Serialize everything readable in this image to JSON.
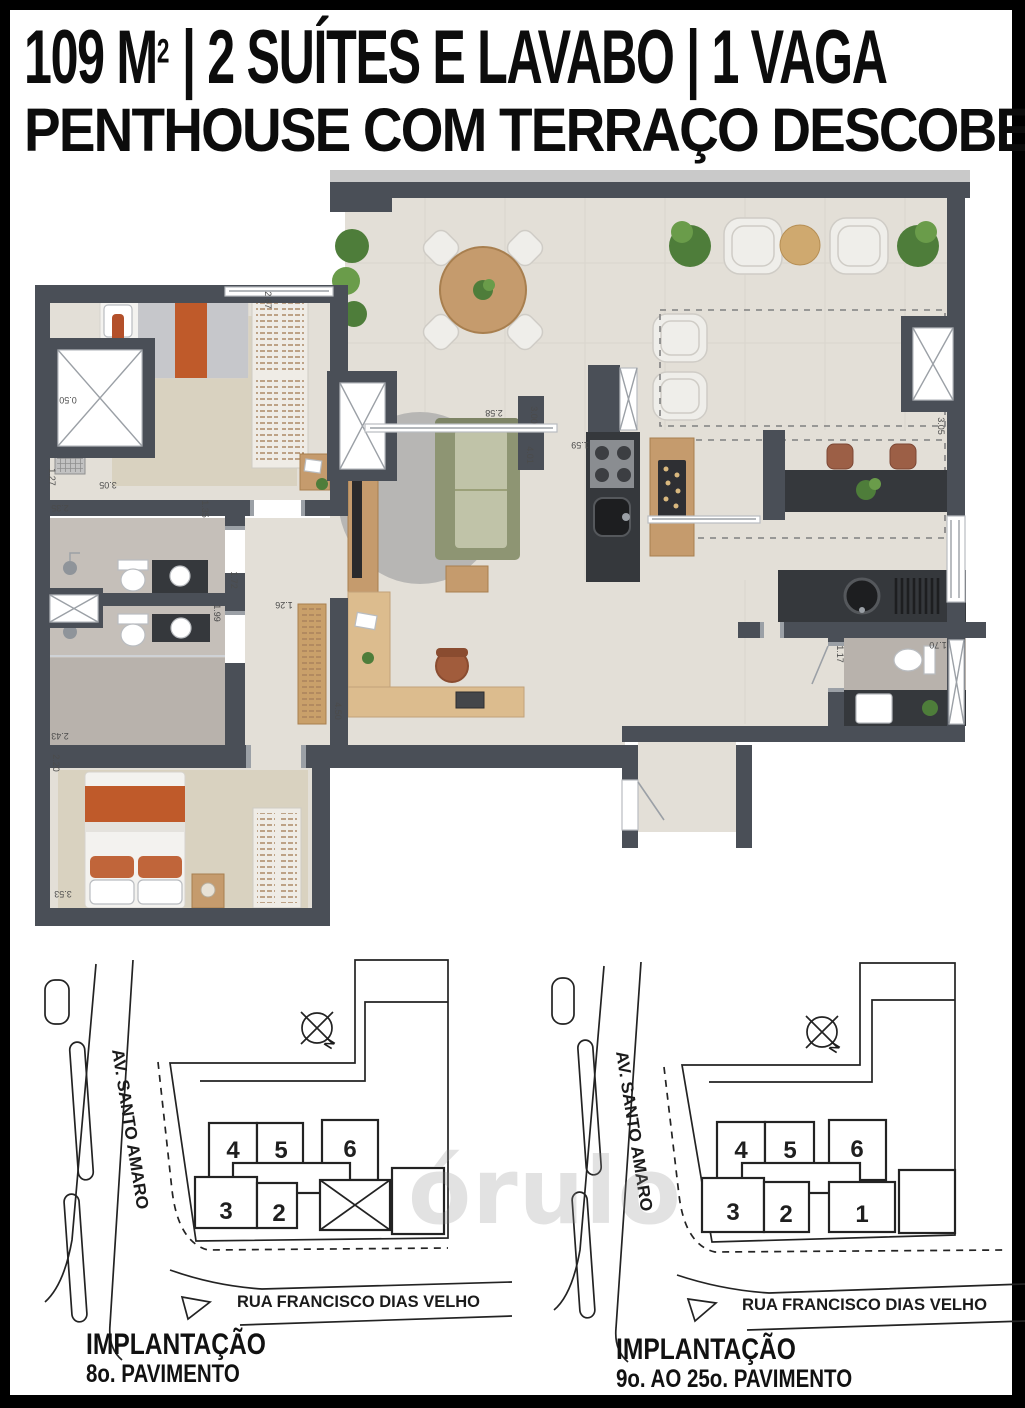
{
  "header": {
    "line1_prefix": "109 M",
    "line1_sup": "2",
    "line1_rest": " | 2 SUÍTES E LAVABO | 1 VAGA",
    "line2": "PENTHOUSE COM TERRAÇO DESCOBERTO"
  },
  "floor_plan": {
    "dims": {
      "suite1_closet": "2.67",
      "ac_w": "0.50",
      "ac_h": "1.27",
      "suite1_w": "3.05",
      "bath1_w": "2.35",
      "suite1_door": "1.35",
      "bath1_l": "1.72",
      "bath2_l": "1.99",
      "hall_w": "1.26",
      "bath2_w": "2.43",
      "suite2_a": "2.20",
      "suite2_w": "3.53",
      "desk_len": "4.50",
      "living_a": "2.58",
      "living_b": "3.00",
      "living_c": "4.01",
      "kitchen_w": "1.59",
      "terrace_d": "3.05",
      "lavabo_w": "1.17",
      "lavabo_l": "1.70"
    }
  },
  "site_plan_left": {
    "avenue": "AV. SANTO AMARO",
    "street": "RUA FRANCISCO DIAS VELHO",
    "compass": "N",
    "units": {
      "u2": "2",
      "u3": "3",
      "u4": "4",
      "u5": "5",
      "u6": "6"
    },
    "caption_line1": "IMPLANTAÇÃO",
    "caption_line2": "8o. PAVIMENTO"
  },
  "site_plan_right": {
    "avenue": "AV. SANTO AMARO",
    "street": "RUA FRANCISCO DIAS VELHO",
    "compass": "N",
    "units": {
      "u1": "1",
      "u2": "2",
      "u3": "3",
      "u4": "4",
      "u5": "5",
      "u6": "6"
    },
    "caption_line1": "IMPLANTAÇÃO",
    "caption_line2": "9o. AO 25o. PAVIMENTO",
    "highlight_fill": "#bdbdbd"
  },
  "watermark": "órulo",
  "colors": {
    "wall": "#4a4f57",
    "counter_dark": "#35383c",
    "accent_orange": "#bf5a2a",
    "sofa_green": "#8e9573",
    "wood": "#c59b6d",
    "floor_beige": "#e3dfd7",
    "bath_gray": "#c5bfb9"
  }
}
